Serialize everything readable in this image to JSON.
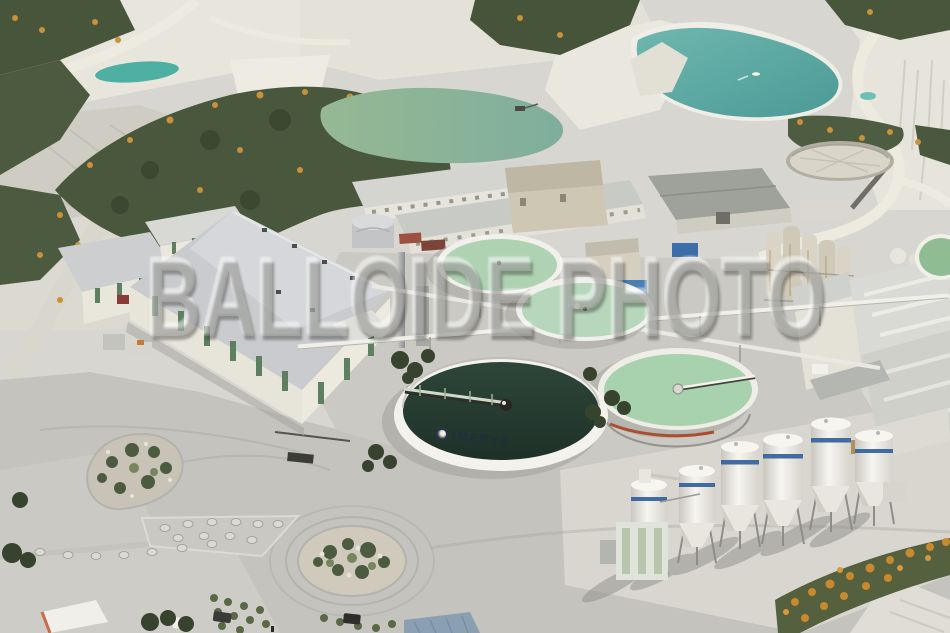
{
  "meta": {
    "type": "aerial-photograph",
    "subject": "china-clay works: settling tanks, warehouses, silos and quarry lakes"
  },
  "watermark": {
    "text": "BALLOIDE PHOTO"
  },
  "labels": {
    "tank_brand": "IMERYS"
  },
  "palette": {
    "terrain_white": "#e8e6dd",
    "terrain_base": "#d8d6d0",
    "road_concrete": "#c4c3be",
    "vegetation_dark": "#49573d",
    "gorse_orange": "#c8913a",
    "lake_teal": "#58a7a3",
    "lake_sage": "#93b691",
    "settling_tank_green": "#aed2b2",
    "imerys_water_dark": "#24382c",
    "tank_rim_white": "#f2f1ea",
    "silo_stripe_blue": "#2f5e9a",
    "roof_gray": "#c7c9cb",
    "wall_cream": "#ebe8de",
    "door_green": "#5f7f61"
  }
}
